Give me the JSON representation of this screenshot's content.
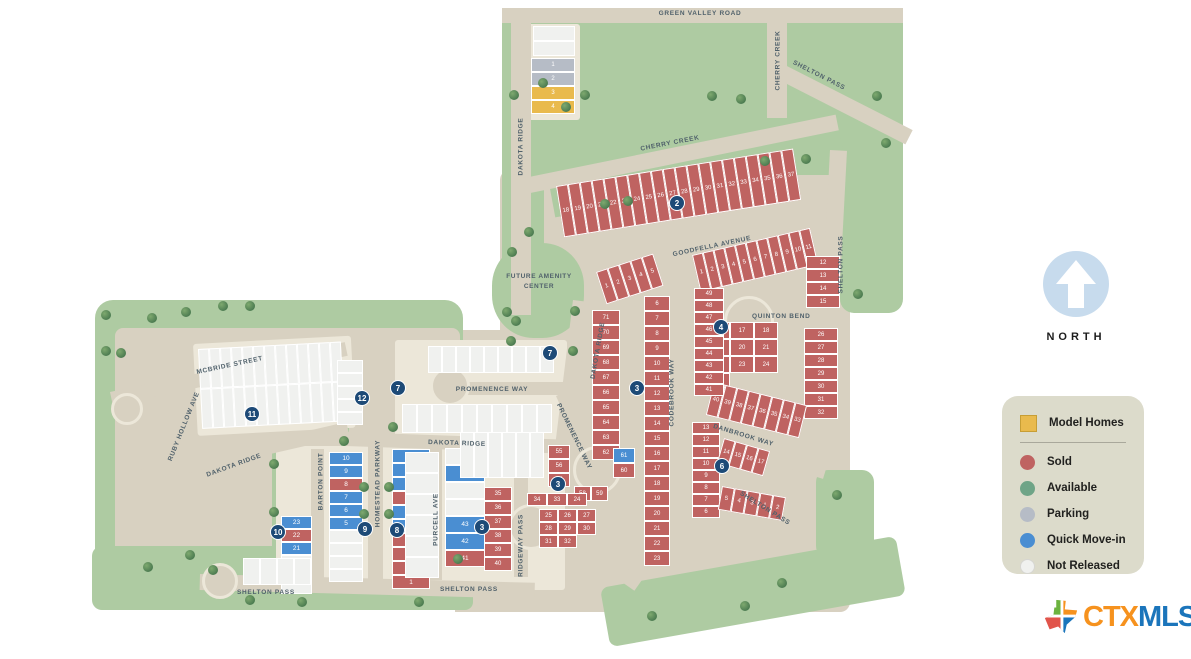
{
  "colors": {
    "road": "#d8d1c1",
    "block": "#ece7d9",
    "green": "#aecba2",
    "sold": "#bf6361",
    "available": "#6fa487",
    "parking": "#b6bcc6",
    "quick": "#4a8ed2",
    "not_released": "#f0f1ef",
    "model": "#e9ba4d",
    "badge": "#1d4a77",
    "street_text": "#50616b",
    "legend_bg": "#dcdbcb",
    "north_blue": "#c7dbed",
    "logo_orange": "#f6921e",
    "logo_blue": "#1b75bb"
  },
  "map": {
    "streets": {
      "green_valley": "GREEN VALLEY ROAD",
      "dakota_ridge": "DAKOTA RIDGE",
      "cherry_creek": "CHERRY CREEK",
      "shelton_pass": "SHELTON PASS",
      "goodfella": "GOODFELLA AVENUE",
      "quinton": "QUINTON BEND",
      "codebrook": "CODEBROOK WAY",
      "danbrook": "DANBROOK WAY",
      "promenence": "PROMENENCE WAY",
      "mcbride": "MCBRIDE STREET",
      "ruby_hollow": "RUBY HOLLOW AVE",
      "barton": "BARTON POINT",
      "homestead": "HOMESTEAD PARKWAY",
      "purcell": "PURCELL AVE",
      "ridgeway": "RIDGEWAY PASS"
    },
    "labels": {
      "future_amenity": "FUTURE AMENITY CENTER"
    },
    "badges": [
      {
        "n": "2"
      },
      {
        "n": "7"
      },
      {
        "n": "7"
      },
      {
        "n": "12"
      },
      {
        "n": "11"
      },
      {
        "n": "3"
      },
      {
        "n": "4"
      },
      {
        "n": "6"
      },
      {
        "n": "3"
      },
      {
        "n": "3"
      },
      {
        "n": "10"
      },
      {
        "n": "9"
      },
      {
        "n": "8"
      }
    ],
    "lots": {
      "above_model": {
        "s": "not_released",
        "n": [
          "",
          ""
        ]
      },
      "model_area": {
        "mixed": [
          {
            "n": "1",
            "s": "parking"
          },
          {
            "n": "2",
            "s": "parking"
          },
          {
            "n": "3",
            "s": "model"
          },
          {
            "n": "4",
            "s": "model"
          }
        ]
      },
      "goodfella_north": {
        "s": "sold",
        "n": [
          "18",
          "19",
          "20",
          "21",
          "22",
          "23",
          "24",
          "25",
          "26",
          "27",
          "28",
          "29",
          "30",
          "31",
          "32",
          "33",
          "34",
          "35",
          "36",
          "37"
        ]
      },
      "quinton_row_1_11": {
        "s": "sold",
        "n": [
          "1",
          "2",
          "3",
          "4",
          "5",
          "6",
          "7",
          "8",
          "9",
          "10",
          "11"
        ]
      },
      "quinton_col_12_15": {
        "s": "sold",
        "n": [
          "12",
          "13",
          "14",
          "15"
        ]
      },
      "quinton_inner": {
        "s": "sold",
        "n": [
          "16",
          "17",
          "18",
          "19",
          "20",
          "21",
          "22",
          "23",
          "24",
          "25"
        ]
      },
      "quinton_col_26_32": {
        "s": "sold",
        "n": [
          "26",
          "27",
          "28",
          "29",
          "30",
          "31",
          "32"
        ]
      },
      "quinton_arc_33_40": {
        "s": "sold",
        "n": [
          "40",
          "39",
          "38",
          "37",
          "36",
          "35",
          "34",
          "33"
        ]
      },
      "quinton_col_41_49": {
        "s": "sold",
        "n": [
          "49",
          "48",
          "47",
          "46",
          "45",
          "44",
          "43",
          "42",
          "41"
        ]
      },
      "sec3_row_1_5": {
        "s": "sold",
        "n": [
          "1",
          "2",
          "3",
          "4",
          "5"
        ]
      },
      "codebrook_col_6_23": {
        "s": "sold",
        "n": [
          "6",
          "7",
          "8",
          "9",
          "10",
          "11",
          "12",
          "13",
          "14",
          "15",
          "16",
          "17",
          "18",
          "19",
          "20",
          "21",
          "22",
          "23"
        ]
      },
      "dakota_col_62_71": {
        "s": "sold",
        "n": [
          "71",
          "70",
          "69",
          "68",
          "67",
          "66",
          "65",
          "64",
          "63",
          "62"
        ]
      },
      "prom_fan_a": {
        "s": "sold",
        "n": [
          "55",
          "56",
          "57"
        ]
      },
      "prom_fan_b": {
        "s": "sold",
        "n": [
          "58",
          "59"
        ]
      },
      "prom_fan_c": {
        "mixed": [
          {
            "n": "61",
            "s": "quick"
          },
          {
            "n": "60",
            "s": "sold"
          }
        ]
      },
      "ridgeway_col_35_40": {
        "s": "sold",
        "n": [
          "35",
          "36",
          "37",
          "38",
          "39",
          "40"
        ]
      },
      "ridgeway_row_34_24": {
        "s": "sold",
        "n": [
          "34",
          "33",
          "24"
        ]
      },
      "ridgeway_fan_25_32": {
        "s": "sold",
        "n": [
          "25",
          "26",
          "27",
          "28",
          "29",
          "30",
          "31",
          "32"
        ]
      },
      "danbrook_col_6_13": {
        "s": "sold",
        "n": [
          "13",
          "12",
          "11",
          "10",
          "9",
          "8",
          "7",
          "6"
        ]
      },
      "danbrook_row_14_17": {
        "s": "sold",
        "n": [
          "14",
          "15",
          "16",
          "17"
        ]
      },
      "danbrook_row_1_5": {
        "s": "sold",
        "n": [
          "5",
          "4",
          "3",
          "1",
          "2"
        ]
      },
      "homestead_col": {
        "mixed": [
          {
            "n": "10",
            "s": "quick"
          },
          {
            "n": "9",
            "s": "quick"
          },
          {
            "n": "8",
            "s": "quick"
          },
          {
            "n": "7",
            "s": "sold"
          },
          {
            "n": "6",
            "s": "quick"
          },
          {
            "n": "5",
            "s": "quick"
          },
          {
            "n": "4",
            "s": "sold"
          },
          {
            "n": "3",
            "s": "sold"
          },
          {
            "n": "2",
            "s": "sold"
          },
          {
            "n": "1",
            "s": "sold"
          }
        ]
      },
      "barton_col": {
        "mixed": [
          {
            "n": "10",
            "s": "quick"
          },
          {
            "n": "9",
            "s": "quick"
          },
          {
            "n": "8",
            "s": "sold"
          },
          {
            "n": "7",
            "s": "quick"
          },
          {
            "n": "6",
            "s": "quick"
          },
          {
            "n": "5",
            "s": "quick"
          },
          {
            "n": "",
            "s": "not_released"
          },
          {
            "n": "",
            "s": "not_released"
          },
          {
            "n": "",
            "s": "not_released"
          },
          {
            "n": "",
            "s": "not_released"
          }
        ]
      },
      "west_col": {
        "mixed": [
          {
            "n": "23",
            "s": "quick"
          },
          {
            "n": "22",
            "s": "sold"
          },
          {
            "n": "21",
            "s": "quick"
          },
          {
            "n": "",
            "s": "not_released"
          },
          {
            "n": "19",
            "s": "quick"
          },
          {
            "n": "",
            "s": "not_released"
          }
        ]
      },
      "purcell_col": {
        "mixed": [
          {
            "n": "",
            "s": "not_released"
          },
          {
            "n": "46",
            "s": "quick"
          },
          {
            "n": "",
            "s": "not_released"
          },
          {
            "n": "",
            "s": "not_released"
          },
          {
            "n": "43",
            "s": "quick"
          },
          {
            "n": "42",
            "s": "quick"
          },
          {
            "n": "41",
            "s": "sold"
          }
        ]
      },
      "purcell_west_col": {
        "s": "not_released",
        "n": [
          "",
          "",
          "",
          "",
          "",
          ""
        ]
      },
      "mcbride_block": {
        "s": "not_released",
        "n": [
          "",
          "",
          "",
          "",
          "",
          "",
          "",
          "",
          "",
          "",
          "",
          "",
          "",
          "",
          "",
          "",
          "",
          "",
          "",
          "",
          "",
          "",
          "",
          "",
          "",
          ""
        ]
      },
      "badge12_col": {
        "s": "not_released",
        "n": [
          "",
          "",
          "",
          "",
          ""
        ]
      },
      "prom_north_row": {
        "s": "not_released",
        "n": [
          "",
          "",
          "",
          "",
          "",
          "",
          "",
          "",
          ""
        ]
      },
      "prom_south_row": {
        "s": "not_released",
        "n": [
          "",
          "",
          "",
          "",
          "",
          "",
          "",
          "",
          "",
          ""
        ]
      },
      "prom_west_row": {
        "s": "not_released",
        "n": [
          "",
          "",
          "",
          "",
          "",
          ""
        ]
      },
      "bottom_row": {
        "s": "not_released",
        "n": [
          "",
          "",
          "",
          ""
        ]
      }
    }
  },
  "legend": {
    "items": [
      {
        "label": "Model Homes",
        "key": "model",
        "shape": "square"
      },
      {
        "label": "Sold",
        "key": "sold",
        "shape": "circle"
      },
      {
        "label": "Available",
        "key": "available",
        "shape": "circle"
      },
      {
        "label": "Parking",
        "key": "parking",
        "shape": "circle"
      },
      {
        "label": "Quick Move-in",
        "key": "quick",
        "shape": "circle"
      },
      {
        "label": "Not Released",
        "key": "not_released",
        "shape": "circle"
      }
    ]
  },
  "north": {
    "label": "NORTH"
  },
  "logo": {
    "part1": "CTX",
    "part2": "MLS"
  }
}
